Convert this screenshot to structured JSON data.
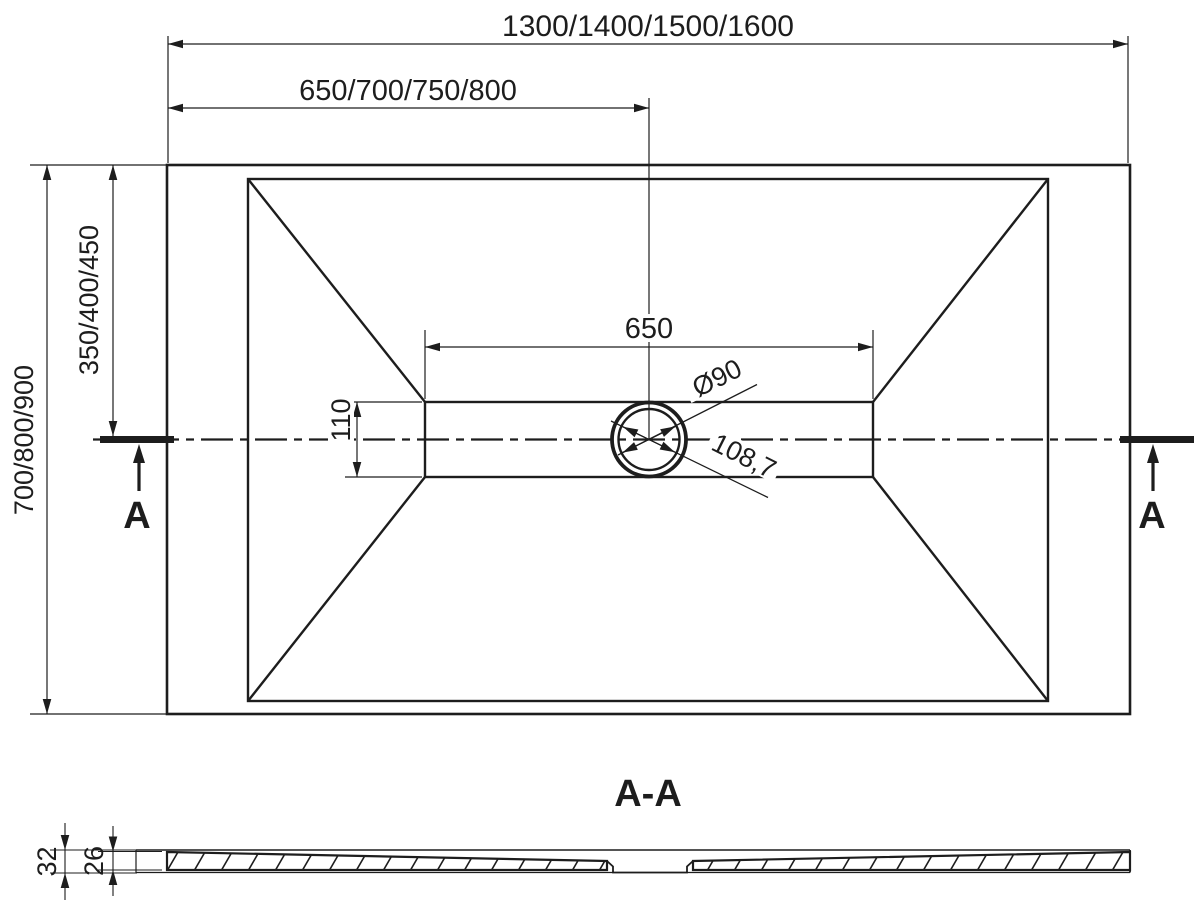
{
  "plan_view": {
    "dim_overall_width": "1300/1400/1500/1600",
    "dim_half_width": "650/700/750/800",
    "dim_overall_depth": "700/800/900",
    "dim_half_depth": "350/400/450",
    "dim_channel_length": "650",
    "dim_channel_width": "110",
    "dim_drain_diameter": "Ø90",
    "dim_drain_flange": "108,7",
    "section_marker_left": "A",
    "section_marker_right": "A"
  },
  "section_view": {
    "title": "A-A",
    "dim_total_thickness": "32",
    "dim_tray_thickness": "26"
  },
  "colors": {
    "ink": "#1d1d1d",
    "paper": "#ffffff"
  }
}
